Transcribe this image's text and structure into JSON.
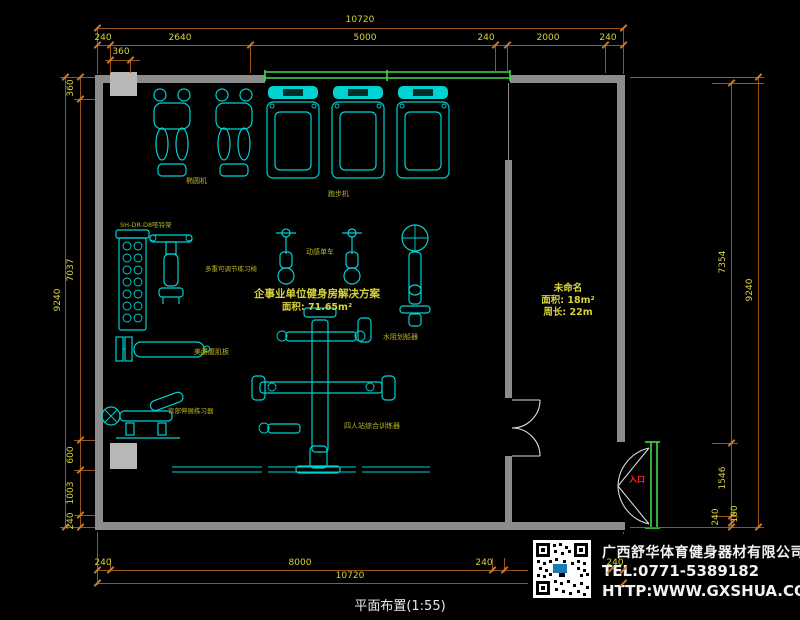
{
  "drawing_title": "平面布置(1:55)",
  "main_room": {
    "title": "企事业单位健身房解决方案",
    "area": "面积: 71.65m²"
  },
  "side_room": {
    "name": "未命名",
    "area": "面积: 18m²",
    "perimeter": "周长: 22m"
  },
  "door_label": "入口",
  "equipment_labels": {
    "elliptical": "椭圆机",
    "treadmill": "跑步机",
    "spin_bike": "动感单车",
    "rower": "水阻划船器",
    "dumbbell_rack": "SH-DR-D8哑铃架",
    "adjustable_bench": "多重可调节练习椅",
    "ab_board": "美腰腹肌板",
    "back_trainer": "背部伸展练习器",
    "multi_trainer": "四人站综合训练器"
  },
  "dims": {
    "top": {
      "overall": "10720",
      "segments": [
        "240",
        "2640",
        "5000",
        "240",
        "2000",
        "240"
      ],
      "sub": "360"
    },
    "left": {
      "overall": "9240",
      "segments": [
        "360",
        "7037",
        "600",
        "1003",
        "240"
      ]
    },
    "right": {
      "overall": "9240",
      "segments": [
        "7354",
        "1546",
        "240",
        "100"
      ]
    },
    "bottom": {
      "overall": "10720",
      "segments": [
        "240",
        "8000",
        "240",
        "240"
      ]
    }
  },
  "company": {
    "name": "广西舒华体育健身器材有限公司",
    "tel": "TEL:0771-5389182",
    "website": "HTTP:WWW.GXSHUA.COM"
  },
  "colors": {
    "bg": "#000000",
    "wall": "#8c8c8c",
    "wall_light": "#b8b8b8",
    "equipment": "#00d2d2",
    "window_green": "#44d944",
    "dim_line": "#9c5418",
    "tick": "#c87830",
    "dim_text": "#d6d23c",
    "label_yellow": "#b9b325",
    "door_white": "#dcdcdc",
    "red_label": "#ff2a2a",
    "company_text": "#f2f2f2"
  }
}
